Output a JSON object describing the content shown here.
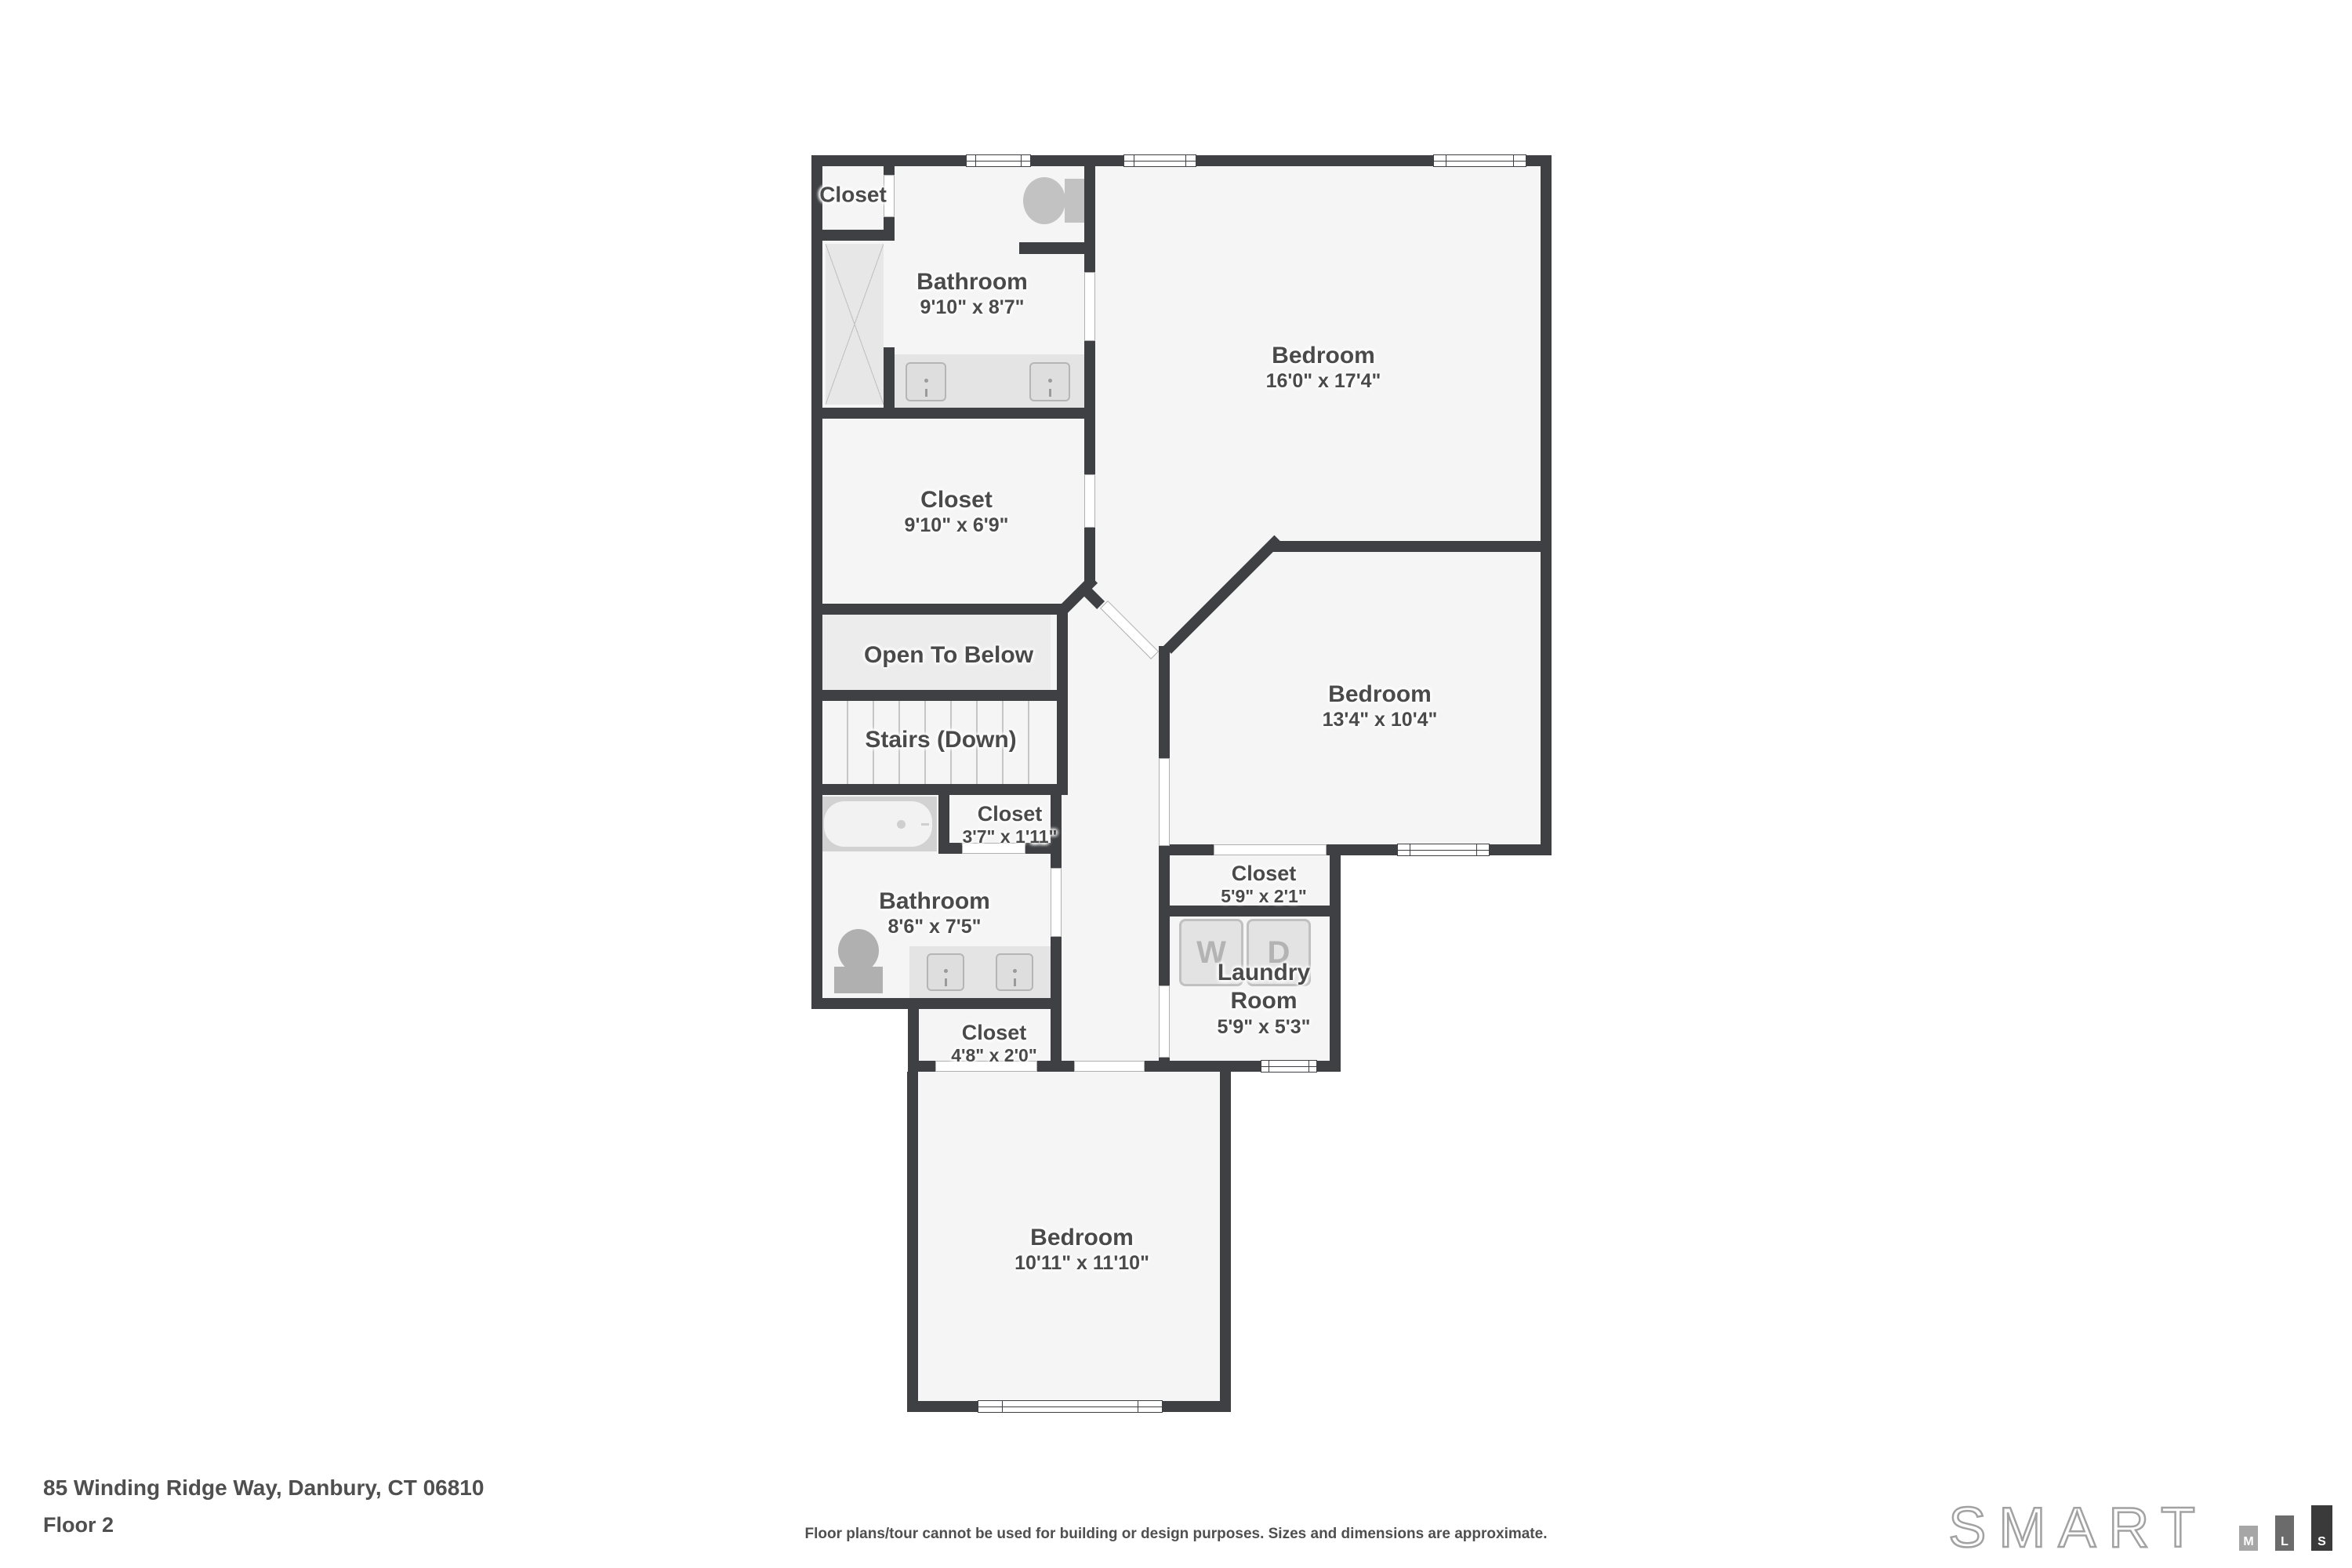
{
  "footer": {
    "address": "85 Winding Ridge Way, Danbury, CT 06810",
    "floor": "Floor 2",
    "disclaimer": "Floor plans/tour cannot be used for building or design purposes. Sizes and dimensions are approximate."
  },
  "logo": {
    "brand": "SMART",
    "bars": [
      "M",
      "L",
      "S"
    ]
  },
  "rooms": [
    {
      "name": "Closet",
      "dims": ""
    },
    {
      "name": "Bathroom",
      "dims": "9'10\" x 8'7\""
    },
    {
      "name": "Bedroom",
      "dims": "16'0\" x 17'4\""
    },
    {
      "name": "Closet",
      "dims": "9'10\" x 6'9\""
    },
    {
      "name": "Open To Below",
      "dims": ""
    },
    {
      "name": "Stairs (Down)",
      "dims": ""
    },
    {
      "name": "Closet",
      "dims": "3'7\" x 1'11\""
    },
    {
      "name": "Bathroom",
      "dims": "8'6\" x 7'5\""
    },
    {
      "name": "Bedroom",
      "dims": "13'4\" x 10'4\""
    },
    {
      "name": "Closet",
      "dims": "5'9\" x 2'1\""
    },
    {
      "name": "Laundry Room",
      "dims": "5'9\" x 5'3\""
    },
    {
      "name": "Closet",
      "dims": "4'8\" x 2'0\""
    },
    {
      "name": "Bedroom",
      "dims": "10'11\" x 11'10\""
    }
  ],
  "fixtures": {
    "washer": "W",
    "dryer": "D"
  },
  "colors": {
    "wall": "#3e4043",
    "room_fill": "#f5f5f5",
    "open_below_fill": "#ececec",
    "label_text": "#4a4a4a",
    "fixture_fill": "#c9c9c9",
    "logo_bar_m": "#a6a6a6",
    "logo_bar_l": "#6b6b6b",
    "logo_bar_s": "#3a3a3a"
  }
}
